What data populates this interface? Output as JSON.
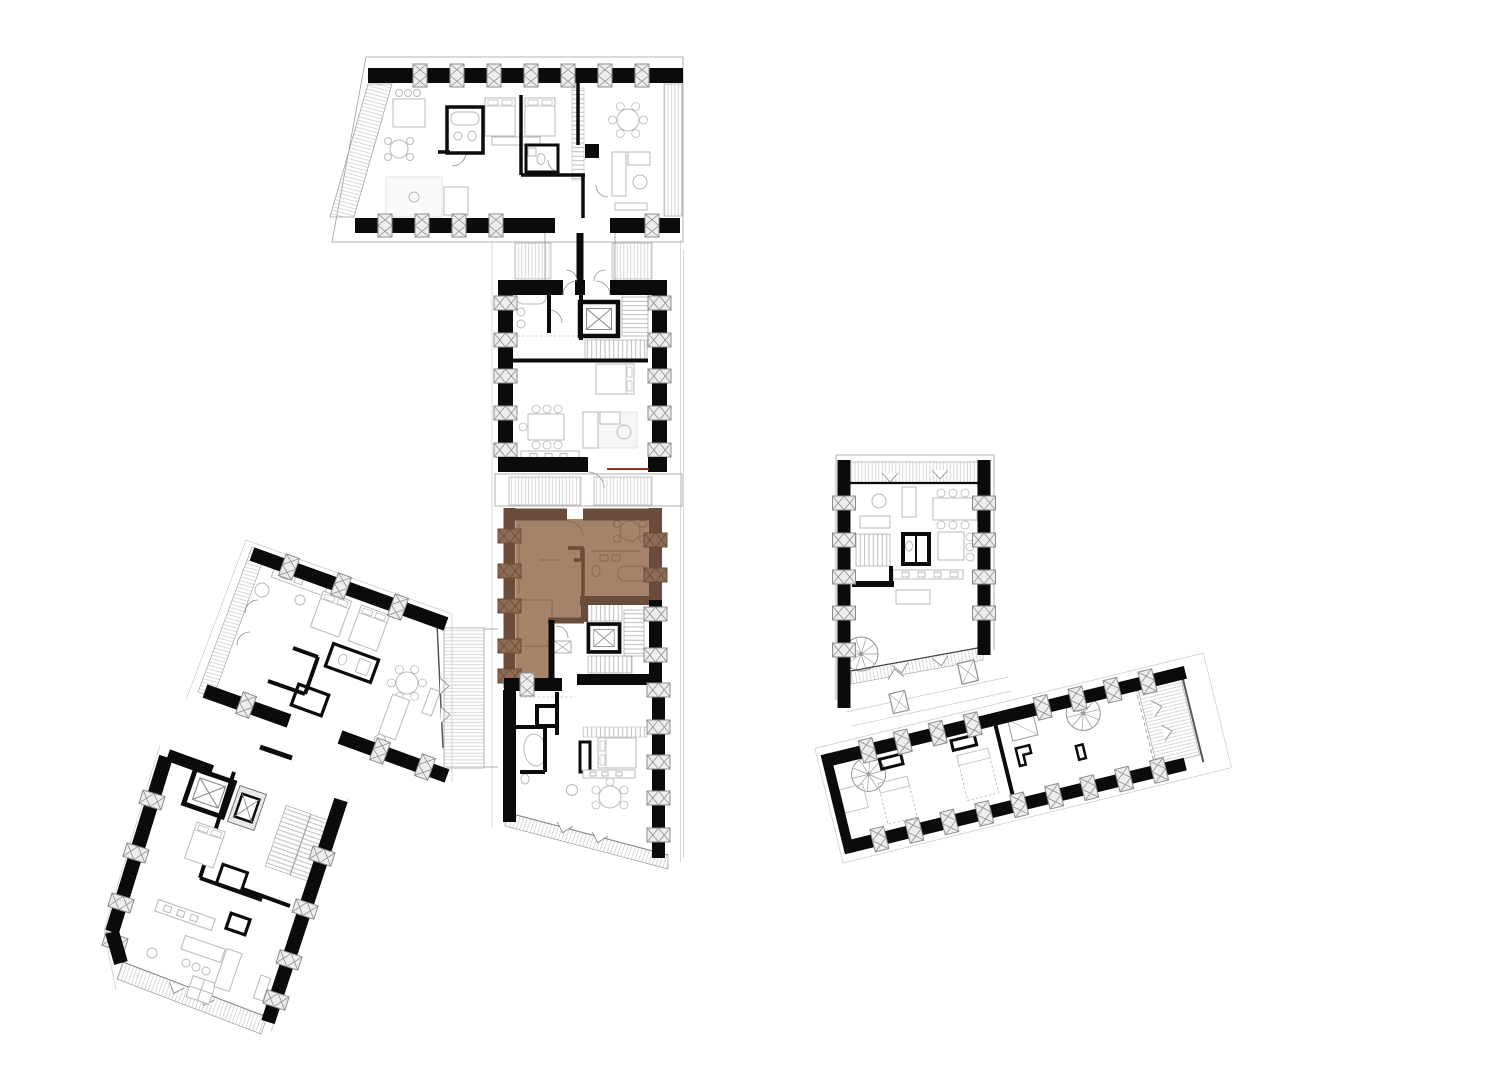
{
  "meta": {
    "kind": "architectural-floor-plan",
    "level": "attic level site plan",
    "note": "multi-building residential plan with one apartment unit highlighted"
  },
  "canvas": {
    "width": 1500,
    "height": 1069,
    "background": "#ffffff"
  },
  "palette": {
    "wall": "#0b0b0b",
    "outline": "#9c9c9c",
    "outline_light": "#c9c9c9",
    "furniture": "#b9b9b9",
    "soft": "#e9e9e9",
    "hatch": "#c9c9c9",
    "stair": "#adadad",
    "pier_fill": "#ededed",
    "pier_stroke": "#8e8e8e",
    "accent": "#8a3524",
    "hl_fill": "#a5836b",
    "hl_wall": "#694c39",
    "hl_pier": "#8d6c55",
    "hl_line": "#8a6a52",
    "bg": "#ffffff"
  },
  "buildings": [
    {
      "id": "north-wing",
      "role": "apartment wing, angled gable ends",
      "highlighted": false
    },
    {
      "id": "central-upper",
      "role": "apartment block with elevator and stair core",
      "highlighted": false
    },
    {
      "id": "selected-unit",
      "role": "highlighted apartment unit",
      "highlighted": true,
      "fill": "#a5836b"
    },
    {
      "id": "central-lower",
      "role": "apartment with south balcony",
      "highlighted": false
    },
    {
      "id": "west-wing",
      "role": "rotated apartment wing with roof terrace",
      "highlighted": false
    },
    {
      "id": "southwest-block",
      "role": "stair tower and apartment",
      "highlighted": false
    },
    {
      "id": "east-block",
      "role": "loft apartment with north terrace",
      "highlighted": false
    },
    {
      "id": "southeast-wing",
      "role": "long attic wing, spiral stairs and end terrace",
      "highlighted": false
    }
  ],
  "symbols": {
    "elevator": "elevator shaft with X",
    "window_pier": "facade pier with cross bracing",
    "spiral_stair": "spiral staircase",
    "stair_flight": "straight stair flight",
    "roof_window": "skylight with diagonal",
    "canopy": "awning / canopy triangle mark",
    "terrace_hatch": "hatched terrace or roof slope"
  }
}
